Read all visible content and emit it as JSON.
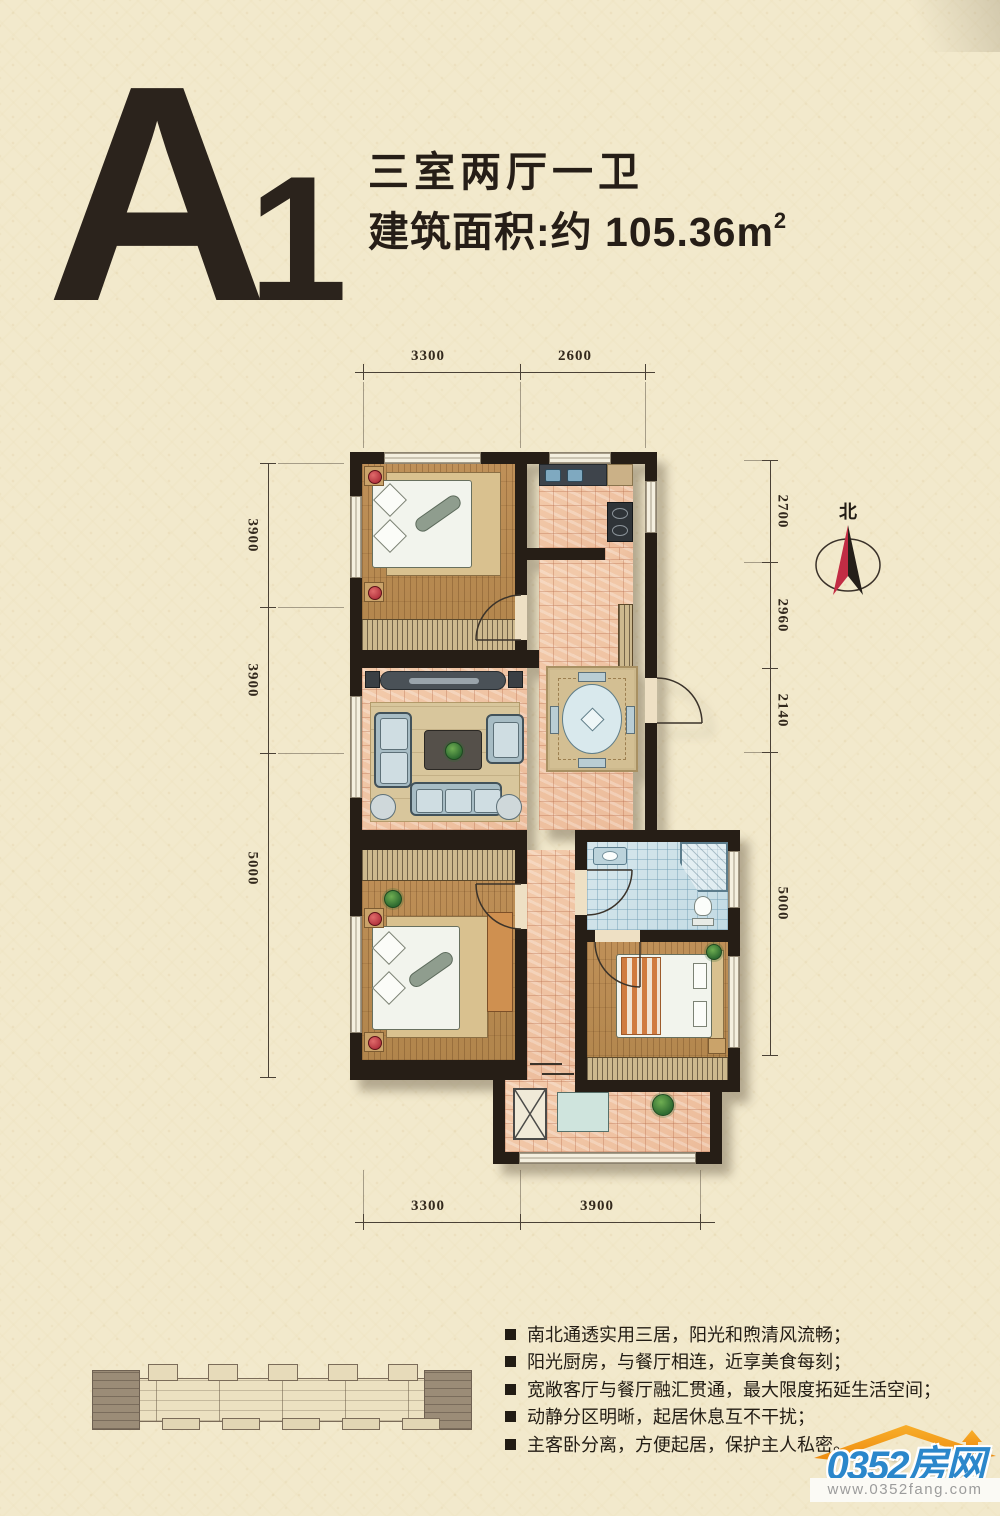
{
  "page": {
    "background": "#f2e9cc"
  },
  "header": {
    "plan_code_letter": "A",
    "plan_code_number": "1",
    "layout_summary": "三室两厅一卫",
    "area_prefix": "建筑面积:约 105.36m",
    "area_superscript": "2"
  },
  "floor_plan": {
    "compass_label": "北",
    "dimensions": {
      "top": [
        "3300",
        "2600"
      ],
      "bottom": [
        "3300",
        "3900"
      ],
      "left": [
        "3900",
        "3900",
        "5000"
      ],
      "right": [
        "2700",
        "2960",
        "2140",
        "5000"
      ]
    }
  },
  "features": {
    "items": [
      "南北通透实用三居，阳光和煦清风流畅；",
      "阳光厨房，与餐厅相连，近享美食每刻；",
      "宽敞客厅与餐厅融汇贯通，最大限度拓延生活空间；",
      "动静分区明晰，起居休息互不干扰；",
      "主客卧分离，方便起居，保护主人私密。"
    ]
  },
  "footer": {
    "logo_text": "0352房网",
    "logo_url": "www.0352fang.com"
  },
  "colors": {
    "paper": "#f2e9cc",
    "ink": "#2a211a",
    "wall": "#261e16",
    "compass_red": "#c22c44",
    "logo_blue": "#2b87cb",
    "logo_orange": "#f49d1c"
  }
}
